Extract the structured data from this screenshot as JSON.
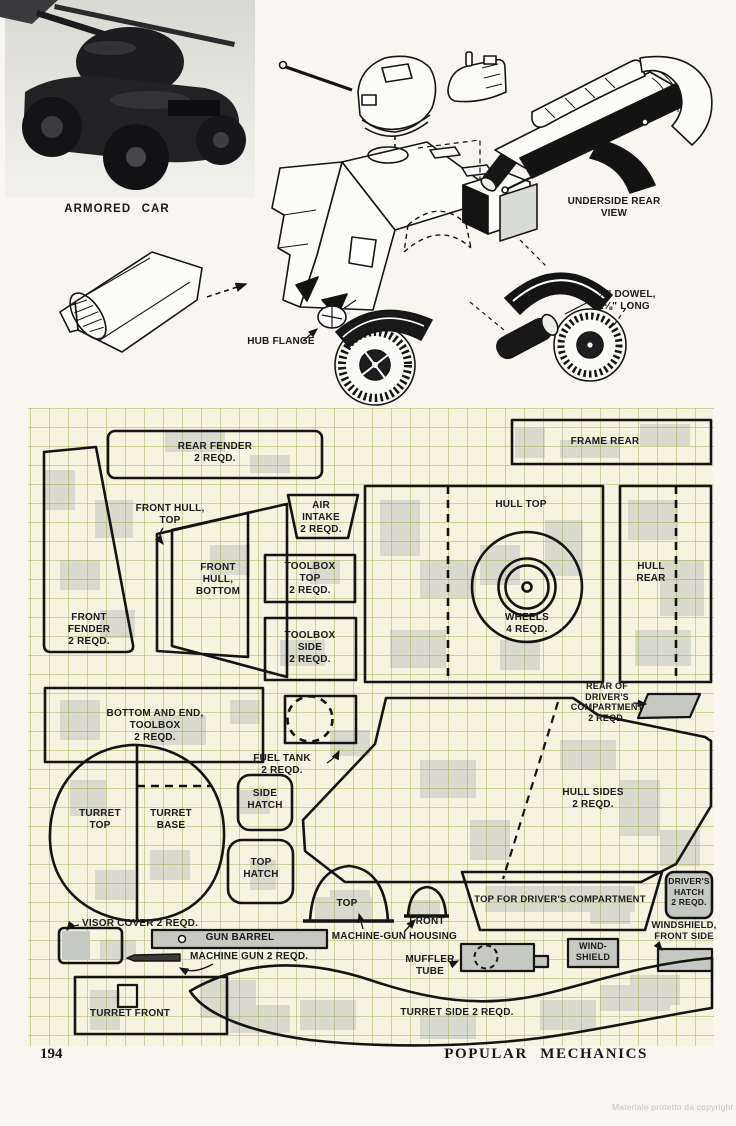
{
  "photo": {
    "caption": "ARMORED CAR"
  },
  "diagram": {
    "underside_label": "UNDERSIDE REAR\nVIEW",
    "hub_flange_label": "HUB FLANGE",
    "dowel_label": "¾\" DOWEL,\n1⅛\" LONG"
  },
  "plan": {
    "labels": {
      "rear_fender": "REAR FENDER\n2 REQD.",
      "frame_rear": "FRAME REAR",
      "front_hull_top": "FRONT HULL,\nTOP",
      "front_fender": "FRONT\nFENDER\n2 REQD.",
      "front_hull_bottom": "FRONT\nHULL,\nBOTTOM",
      "air_intake": "AIR\nINTAKE\n2 REQD.",
      "toolbox_top": "TOOLBOX\nTOP\n2 REQD.",
      "toolbox_side": "TOOLBOX\nSIDE\n2 REQD.",
      "hull_top": "HULL TOP",
      "wheels": "WHEELS\n4 REQD.",
      "hull_rear": "HULL\nREAR",
      "bottom_end_toolbox": "BOTTOM AND END,\nTOOLBOX\n2 REQD.",
      "fuel_tank": "FUEL TANK\n2 REQD.",
      "rear_drivers_compartment": "REAR OF\nDRIVER'S\nCOMPARTMENT\n2 REQD.",
      "turret_top": "TURRET\nTOP",
      "turret_base": "TURRET\nBASE",
      "side_hatch": "SIDE\nHATCH",
      "top_hatch": "TOP\nHATCH",
      "hull_sides": "HULL SIDES\n2 REQD.",
      "machine_gun_top": "TOP",
      "machine_gun_word": "MACHINE-GUN",
      "front_word": "FRONT",
      "housing_word": "HOUSING",
      "top_drivers_compartment": "TOP FOR DRIVER'S COMPARTMENT",
      "drivers_hatch": "DRIVER'S\nHATCH\n2 REQD.",
      "windshield_front_side": "WINDSHIELD,\nFRONT SIDE",
      "wind_shield": "WIND-\nSHIELD",
      "visor_cover": "VISOR COVER 2 REQD.",
      "gun_barrel": "GUN BARREL",
      "machine_gun": "MACHINE GUN 2 REQD.",
      "muffler_tube": "MUFFLER\nTUBE",
      "turret_front": "TURRET FRONT",
      "turret_side": "TURRET SIDE 2 REQD."
    }
  },
  "footer": {
    "page_number": "194",
    "magazine_title": "POPULAR MECHANICS",
    "watermark": "Materiale protetto da copyright"
  }
}
